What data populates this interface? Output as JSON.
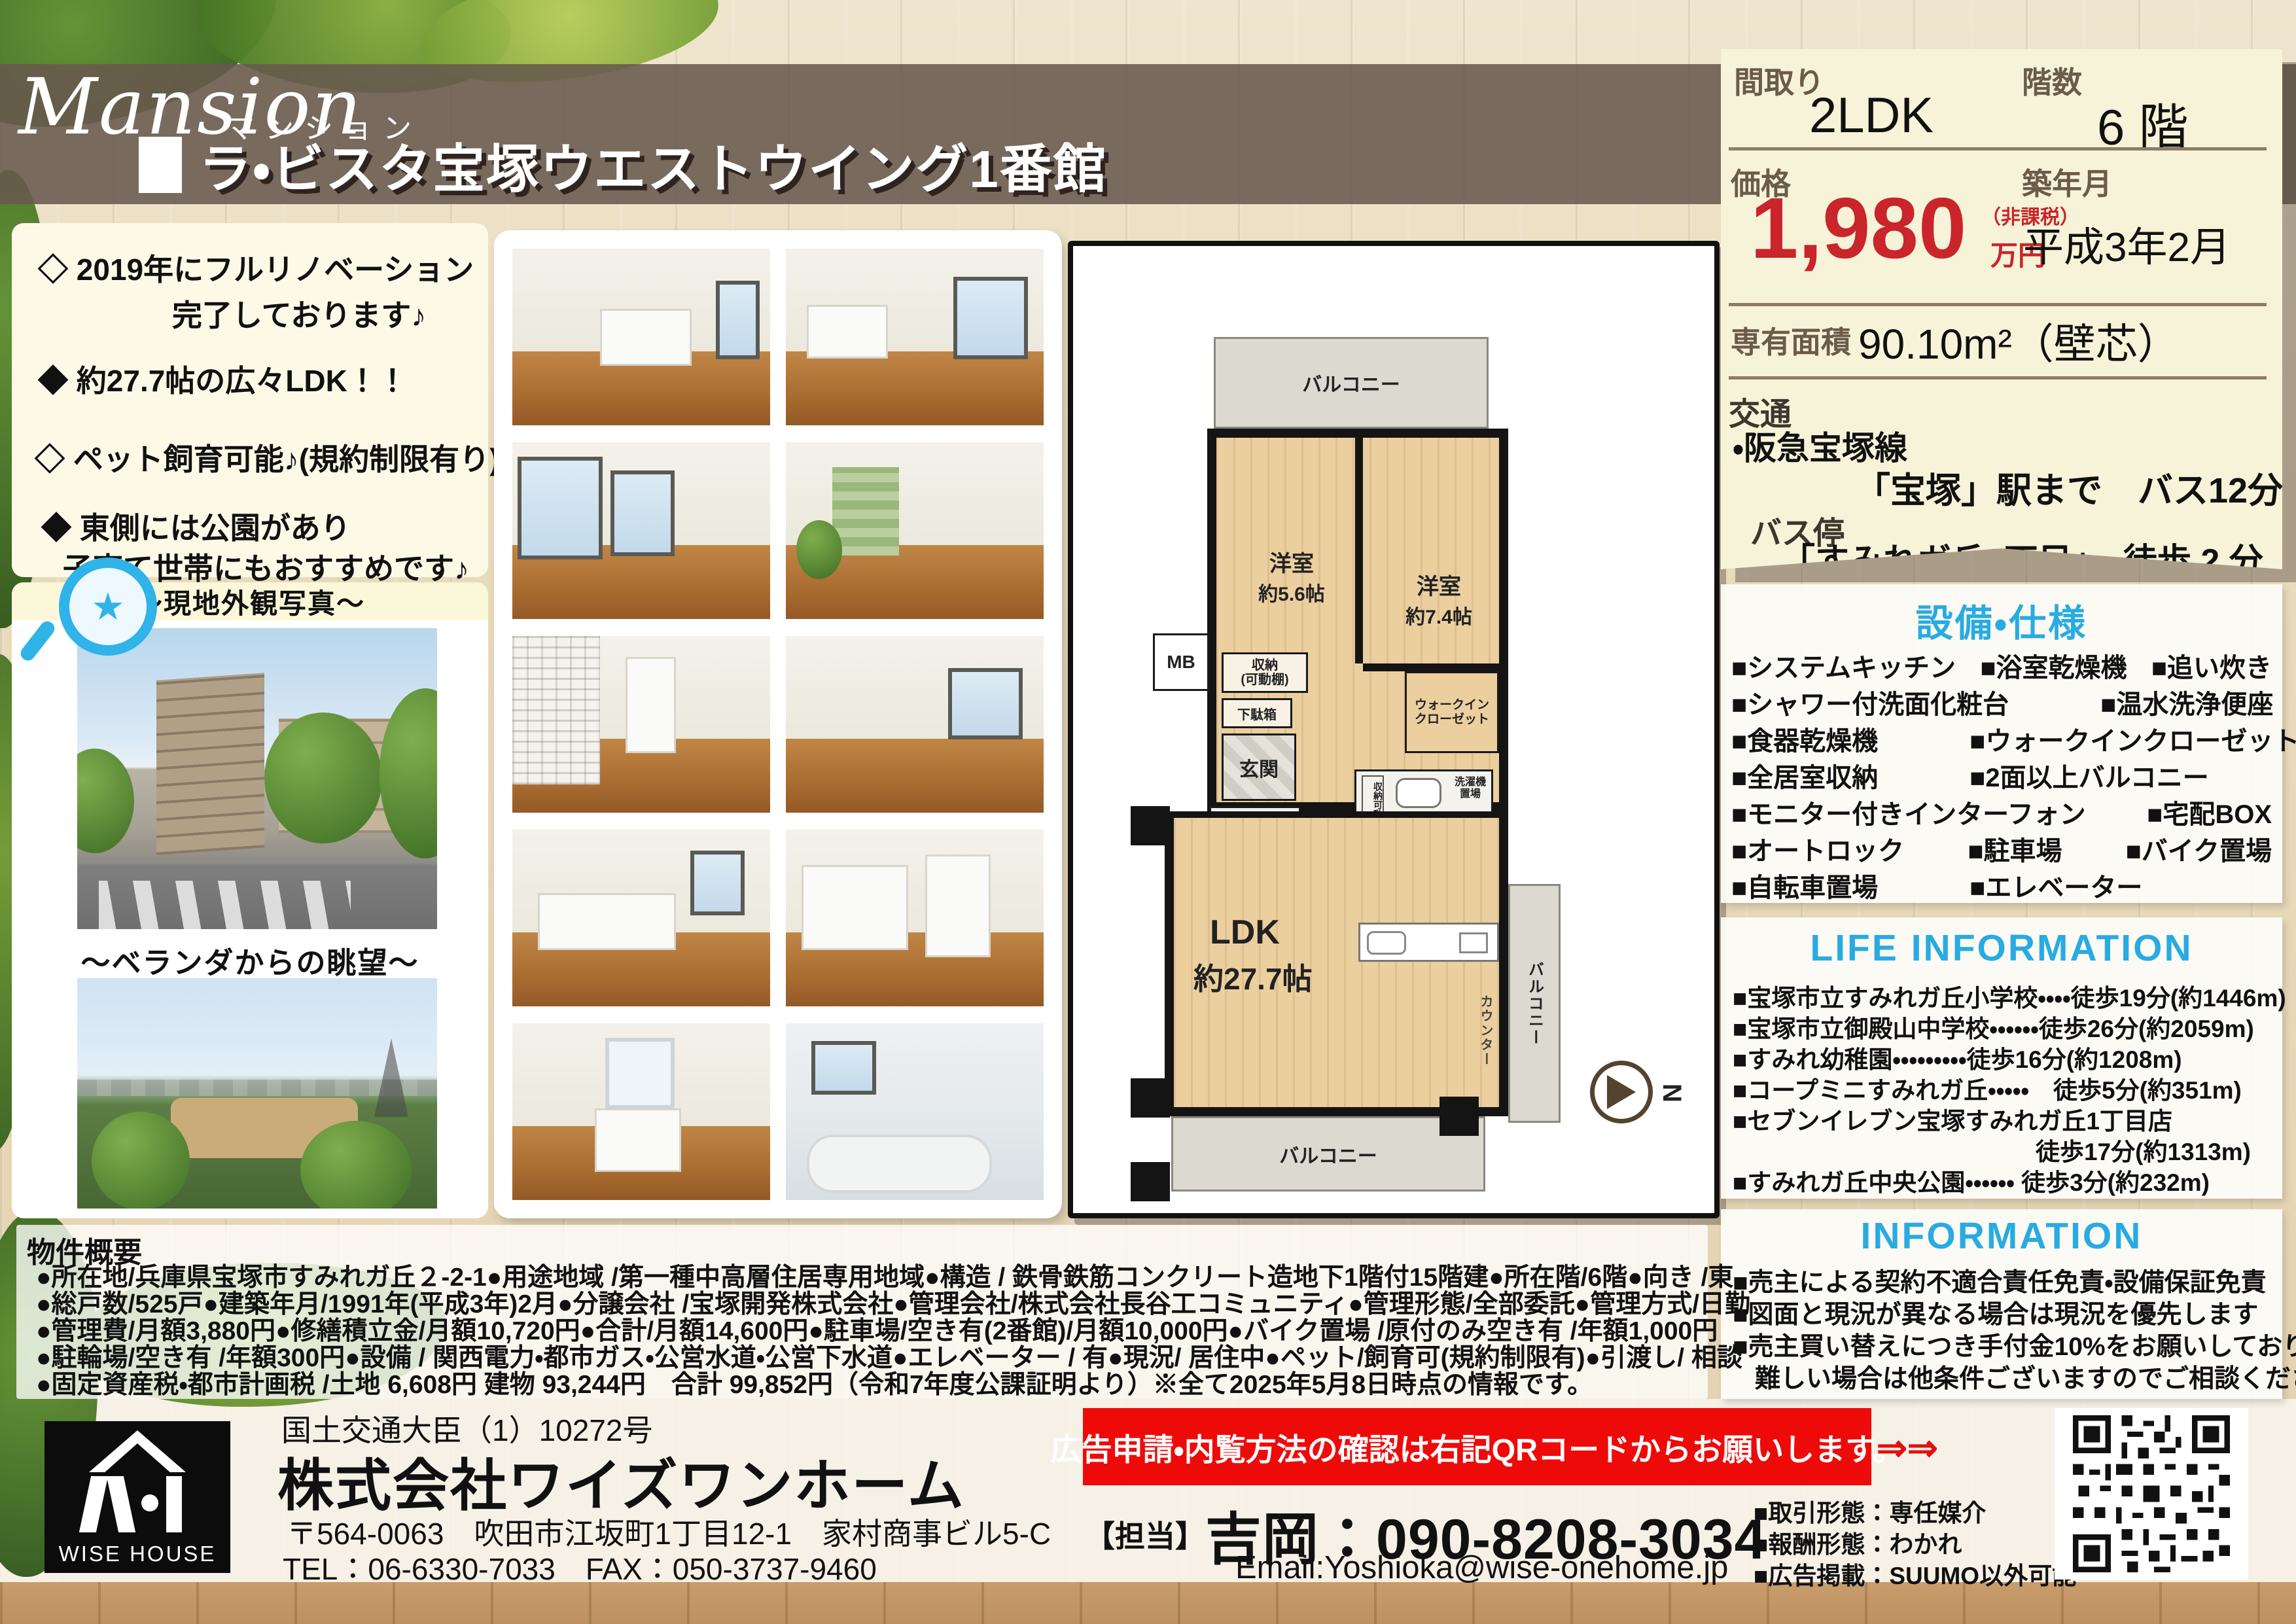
{
  "header": {
    "brand_en": "Mansion",
    "brand_ja": "マンション",
    "property_name": "ラ・ビスタ宝塚ウエストウイング1番館"
  },
  "key_info": {
    "madori_label": "間取り",
    "madori_value": "2LDK",
    "kaisu_label": "階数",
    "kaisu_value": "6 階",
    "price_label": "価格",
    "price_value": "1,980",
    "price_note1": "（非課税）",
    "price_note2": "万円",
    "chiku_label": "築年月",
    "chiku_value": "平成3年2月",
    "senyu_label": "専有面積",
    "senyu_value": "90.10m²（壁芯）",
    "kotsu_label": "交通",
    "kotsu_line1": "・阪急宝塚線",
    "kotsu_line2": "「宝塚」駅まで　バス12分",
    "busstop_label": "バス停",
    "busstop_value": "「すみれガ丘2丁目」　徒歩 2 分"
  },
  "features": {
    "item1_line1": "◇ 2019年にフルリノベーション",
    "item1_line2": "完了しております♪",
    "item2": "◆ 約27.7帖の広々LDK！！",
    "item3": "◇ ペット飼育可能♪(規約制限有り)",
    "item4_line1": "◆ 東側には公園があり",
    "item4_line2": "子育て世帯にもおすすめです♪"
  },
  "photos": {
    "exterior_label": "～現地外観写真～",
    "veranda_label": "～ベランダからの眺望～"
  },
  "floorplan": {
    "balcony_top": "バルコニー",
    "room1_name": "洋室",
    "room1_size": "約5.6帖",
    "room2_name": "洋室",
    "room2_size": "約7.4帖",
    "storage1_line1": "収納",
    "storage1_line2": "(可動棚)",
    "getabako": "下駄箱",
    "genkan": "玄関",
    "wic_line1": "ウォークイン",
    "wic_line2": "クローゼット",
    "mb": "MB",
    "laundry_line1": "洗濯機",
    "laundry_line2": "置場",
    "storage2": "収納可動棚",
    "ldk_name": "LDK",
    "ldk_size": "約27.7帖",
    "counter": "カウンター",
    "balcony_right": "バルコニー",
    "balcony_bottom": "バルコニー",
    "compass_n": "N"
  },
  "equipment": {
    "title": "設備・仕様",
    "items": [
      "■システムキッチン",
      "■浴室乾燥機",
      "■追い炊き",
      "■シャワー付洗面化粧台",
      "■温水洗浄便座",
      "■食器乾燥機",
      "■ウォークインクローゼット",
      "■全居室収納",
      "■2面以上バルコニー",
      "■モニター付きインターフォン",
      "■宅配BOX",
      "■オートロック",
      "■駐車場",
      "■バイク置場",
      "■自転車置場",
      "■エレベーター"
    ]
  },
  "life_info": {
    "title": "LIFE INFORMATION",
    "lines": [
      "■宝塚市立すみれガ丘小学校・・・・徒歩19分(約1446m)",
      "■宝塚市立御殿山中学校・・・・・・徒歩26分(約2059m)",
      "■すみれ幼稚園・・・・・・・・・徒歩16分(約1208m)",
      "■コープミニすみれガ丘・・・・・　徒歩5分(約351m)",
      "■セブンイレブン宝塚すみれガ丘1丁目店",
      "徒歩17分(約1313m)",
      "■すみれガ丘中央公園・・・・・・ 徒歩3分(約232m)"
    ]
  },
  "information": {
    "title": "INFORMATION",
    "lines": [
      "■売主による契約不適合責任免責・設備保証免責",
      "■図面と現況が異なる場合は現況を優先します",
      "■売主買い替えにつき手付金10%をお願いしております。",
      "難しい場合は他条件ございますのでご相談ください。"
    ]
  },
  "overview": {
    "title": "物件概要",
    "lines": [
      "●所在地/兵庫県宝塚市すみれガ丘２-2-1●用途地域 /第一種中高層住居専用地域●構造 / 鉄骨鉄筋コンクリート造地下1階付15階建●所在階/6階●向き /東",
      "●総戸数/525戸●建築年月/1991年(平成3年)2月●分譲会社 /宝塚開発株式会社●管理会社/株式会社長谷工コミュニティ●管理形態/全部委託●管理方式/日勤",
      "●管理費/月額3,880円●修繕積立金/月額10,720円●合計/月額14,600円●駐車場/空き有(2番館)/月額10,000円●バイク置場 /原付のみ空き有 /年額1,000円",
      "●駐輪場/空き有 /年額300円●設備 / 関西電力・都市ガス・公営水道・公営下水道●エレベーター / 有●現況/ 居住中●ペット/飼育可(規約制限有)●引渡し/ 相談",
      "●固定資産税・都市計画税 /土地 6,608円 建物 93,244円　合計 99,852円（令和7年度公課証明より）※全て2025年5月8日時点の情報です。"
    ]
  },
  "footer": {
    "license": "国土交通大臣（1）10272号",
    "company": "株式会社ワイズワンホーム",
    "address": "〒564-0063　吹田市江坂町1丁目12-1　家村商事ビル5-C",
    "tel_fax": "TEL：06-6330-7033　FAX：050-3737-9460",
    "logo_text": "WISE HOUSE",
    "banner": "広告申請・内覧方法の確認は右記QRコードからお願いします。",
    "banner_arrows": "⇒⇒",
    "contact_label": "【担当】",
    "contact_value": "吉岡：090-8208-3034",
    "email": "Email:Yoshioka@wise-onehome.jp",
    "deal1": "■取引形態：専任媒介",
    "deal2": "■報酬形態：わかれ",
    "deal3": "■広告掲載：SUUMO以外可能"
  },
  "colors": {
    "accent_blue": "#29abe2",
    "price_red": "#c9252b",
    "banner_red": "#ef0a0a",
    "band_brown": "#68594d",
    "panel_cream": "#f7f3d8"
  }
}
